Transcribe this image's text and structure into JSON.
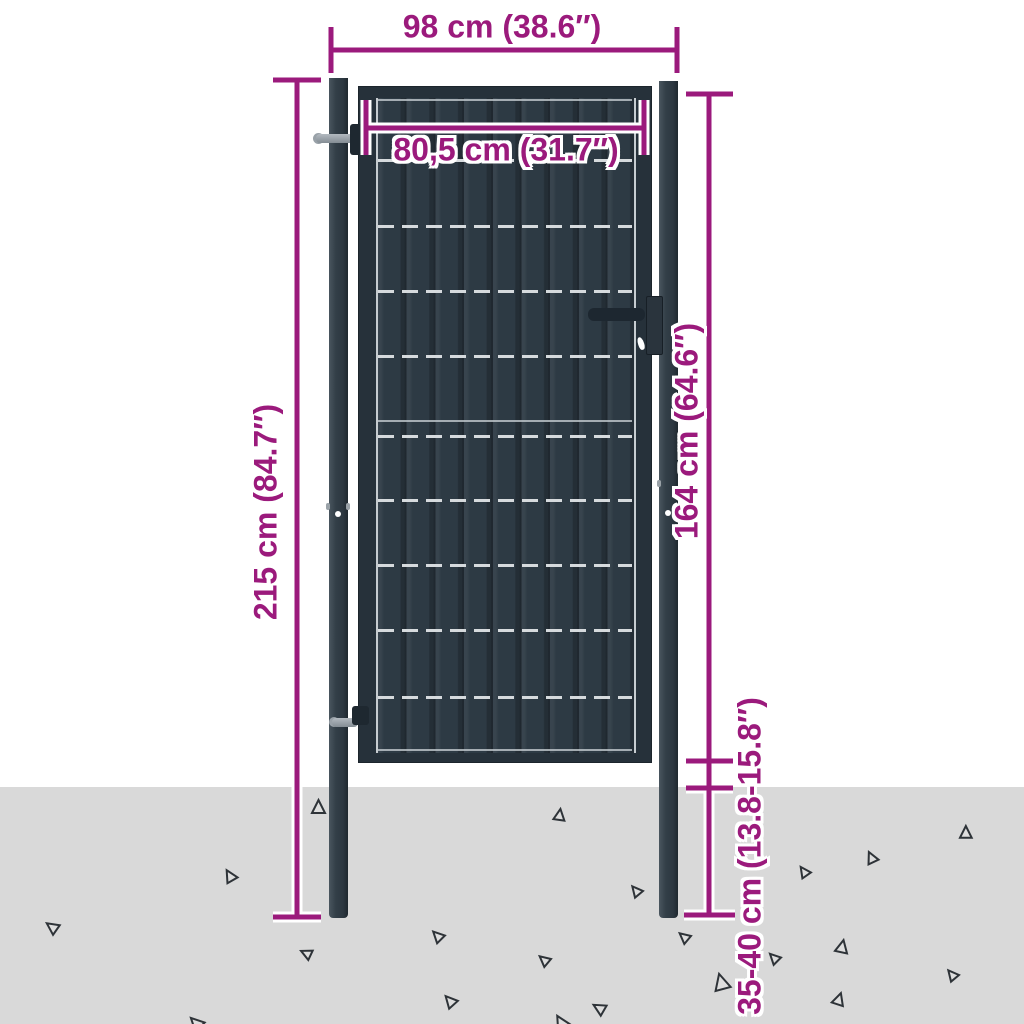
{
  "dimensions": {
    "overall_width": "98 cm (38.6″)",
    "gate_width": "80,5 cm (31.7″)",
    "overall_height": "215 cm (84.7″)",
    "gate_height": "164 cm (64.6″)",
    "post_depth": "35-40 cm (13.8-15.8″)"
  },
  "colors": {
    "accent": "#9b1a7c",
    "gate": "#2d3a44",
    "frame": "#26313a",
    "post": "#333f48",
    "ground": "#d9d9d9",
    "wire": "#d6dadd",
    "triangle_stroke": "#2e3338"
  },
  "gate": {
    "wires": [
      {
        "y": 100,
        "type": "solid"
      },
      {
        "y": 160,
        "type": "dashed"
      },
      {
        "y": 226,
        "type": "dashed"
      },
      {
        "y": 291,
        "type": "dashed"
      },
      {
        "y": 356,
        "type": "dashed"
      },
      {
        "y": 421,
        "type": "solid"
      },
      {
        "y": 436,
        "type": "dashed"
      },
      {
        "y": 500,
        "type": "dashed"
      },
      {
        "y": 565,
        "type": "dashed"
      },
      {
        "y": 630,
        "type": "dashed"
      },
      {
        "y": 697,
        "type": "dashed"
      },
      {
        "y": 750,
        "type": "solid"
      }
    ]
  },
  "decor": {
    "triangles": [
      {
        "x": 312,
        "y": 800,
        "r": 0,
        "s": 1.0
      },
      {
        "x": 554,
        "y": 809,
        "r": 8,
        "s": 0.85
      },
      {
        "x": 960,
        "y": 826,
        "r": 0,
        "s": 0.9
      },
      {
        "x": 866,
        "y": 851,
        "r": -25,
        "s": 0.85
      },
      {
        "x": 799,
        "y": 865,
        "r": -35,
        "s": 0.8
      },
      {
        "x": 224,
        "y": 869,
        "r": -30,
        "s": 0.9
      },
      {
        "x": 631,
        "y": 884,
        "r": -40,
        "s": 0.8
      },
      {
        "x": 46,
        "y": 920,
        "r": -55,
        "s": 0.9
      },
      {
        "x": 432,
        "y": 929,
        "r": -45,
        "s": 0.85
      },
      {
        "x": 679,
        "y": 930,
        "r": -50,
        "s": 0.8
      },
      {
        "x": 301,
        "y": 946,
        "r": -65,
        "s": 0.8
      },
      {
        "x": 836,
        "y": 940,
        "r": 12,
        "s": 0.95
      },
      {
        "x": 769,
        "y": 951,
        "r": -45,
        "s": 0.8
      },
      {
        "x": 539,
        "y": 953,
        "r": -50,
        "s": 0.8
      },
      {
        "x": 947,
        "y": 968,
        "r": -40,
        "s": 0.8
      },
      {
        "x": 713,
        "y": 974,
        "r": -15,
        "s": 1.2
      },
      {
        "x": 833,
        "y": 993,
        "r": 18,
        "s": 0.9
      },
      {
        "x": 444,
        "y": 994,
        "r": -42,
        "s": 0.9
      },
      {
        "x": 593,
        "y": 1001,
        "r": -60,
        "s": 0.9
      },
      {
        "x": 189,
        "y": 1016,
        "r": -45,
        "s": 1.0
      },
      {
        "x": 554,
        "y": 1015,
        "r": -30,
        "s": 1.0
      }
    ]
  }
}
